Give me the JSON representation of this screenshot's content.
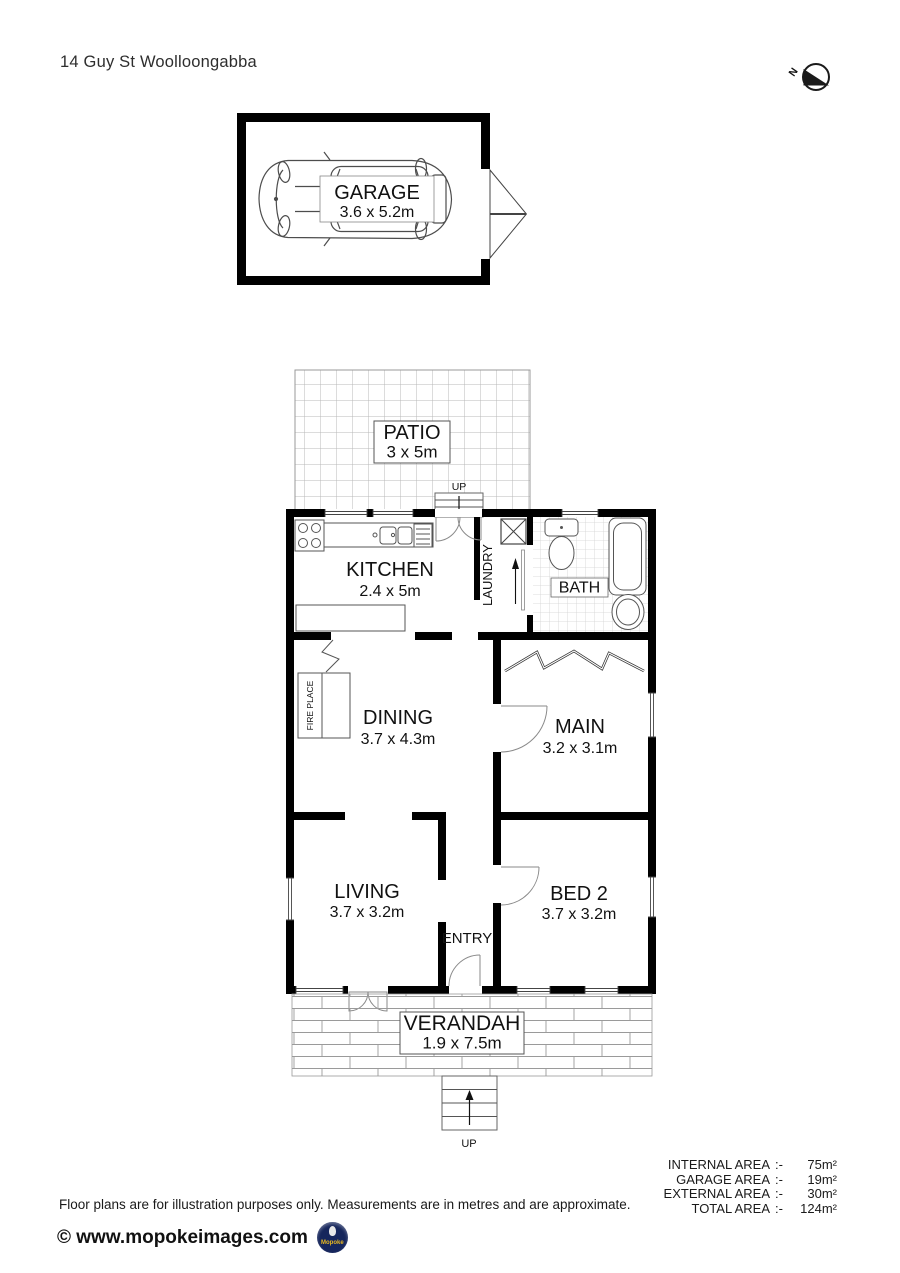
{
  "title": "14 Guy St Woolloongabba",
  "compass": {
    "north_label": "N"
  },
  "rooms": {
    "garage": {
      "name": "GARAGE",
      "dims": "3.6 x 5.2m"
    },
    "patio": {
      "name": "PATIO",
      "dims": "3 x 5m"
    },
    "kitchen": {
      "name": "KITCHEN",
      "dims": "2.4 x 5m"
    },
    "laundry": {
      "name": "LAUNDRY"
    },
    "bath": {
      "name": "BATH"
    },
    "dining": {
      "name": "DINING",
      "dims": "3.7 x 4.3m"
    },
    "main": {
      "name": "MAIN",
      "dims": "3.2 x 3.1m"
    },
    "living": {
      "name": "LIVING",
      "dims": "3.7 x 3.2m"
    },
    "bed2": {
      "name": "BED 2",
      "dims": "3.7 x 3.2m"
    },
    "verandah": {
      "name": "VERANDAH",
      "dims": "1.9 x 7.5m"
    },
    "entry": {
      "name": "ENTRY"
    },
    "fireplace": {
      "name": "FIRE PLACE"
    }
  },
  "stairs": {
    "patio_label": "UP",
    "front_label": "UP"
  },
  "areas": {
    "rows": [
      {
        "label": "INTERNAL AREA",
        "sep": ":-",
        "value": "75m²"
      },
      {
        "label": "GARAGE AREA",
        "sep": ":-",
        "value": "19m²"
      },
      {
        "label": "EXTERNAL AREA",
        "sep": ":-",
        "value": "30m²"
      },
      {
        "label": "TOTAL AREA",
        "sep": ":-",
        "value": "124m²"
      }
    ]
  },
  "footer": {
    "disclaimer": "Floor plans are for illustration purposes only. Measurements are in metres and are approximate.",
    "copyright": "© www.mopokeimages.com",
    "logo_text": "Mopoke"
  },
  "colors": {
    "wall": "#000000",
    "logo_navy": "#16265c",
    "logo_yellow": "#e8b820"
  }
}
